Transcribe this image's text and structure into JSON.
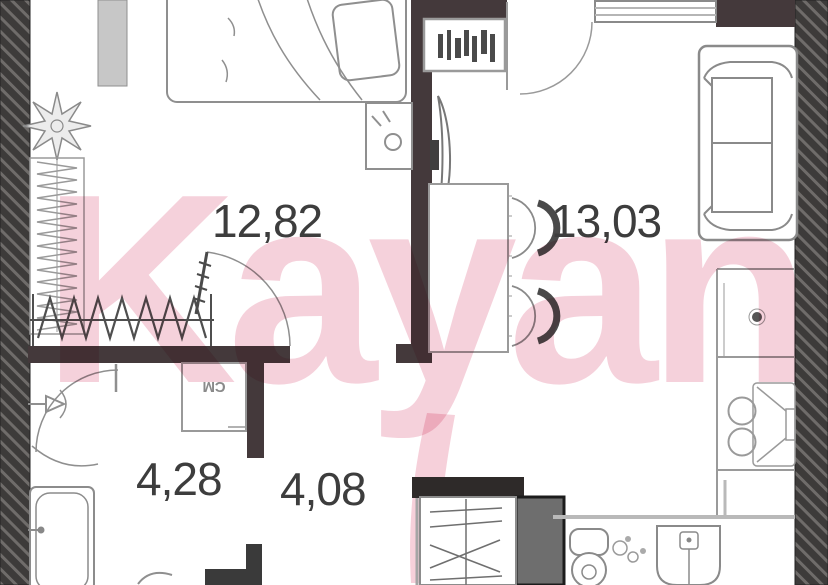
{
  "title": "Apartment floor plan",
  "watermark": {
    "text": "Kayan",
    "color": "#f4c9d5"
  },
  "rooms": [
    {
      "name": "bedroom",
      "area": "12,82"
    },
    {
      "name": "kitchen-living-room",
      "area": "13,03"
    },
    {
      "name": "bathroom",
      "area": "4,28"
    },
    {
      "name": "hallway",
      "area": "4,08"
    }
  ],
  "labels": {
    "washing_machine": "СМ"
  },
  "colors": {
    "wall_dark": "#44393b",
    "wall_black": "#2e2a29",
    "hatch_bg": "#3d3b3a",
    "hatch_line": "#6f6c6a",
    "furniture_stroke": "#8f8f8f",
    "label_text": "#3d3d3d",
    "watermark_pink": "#f4c9d5"
  }
}
